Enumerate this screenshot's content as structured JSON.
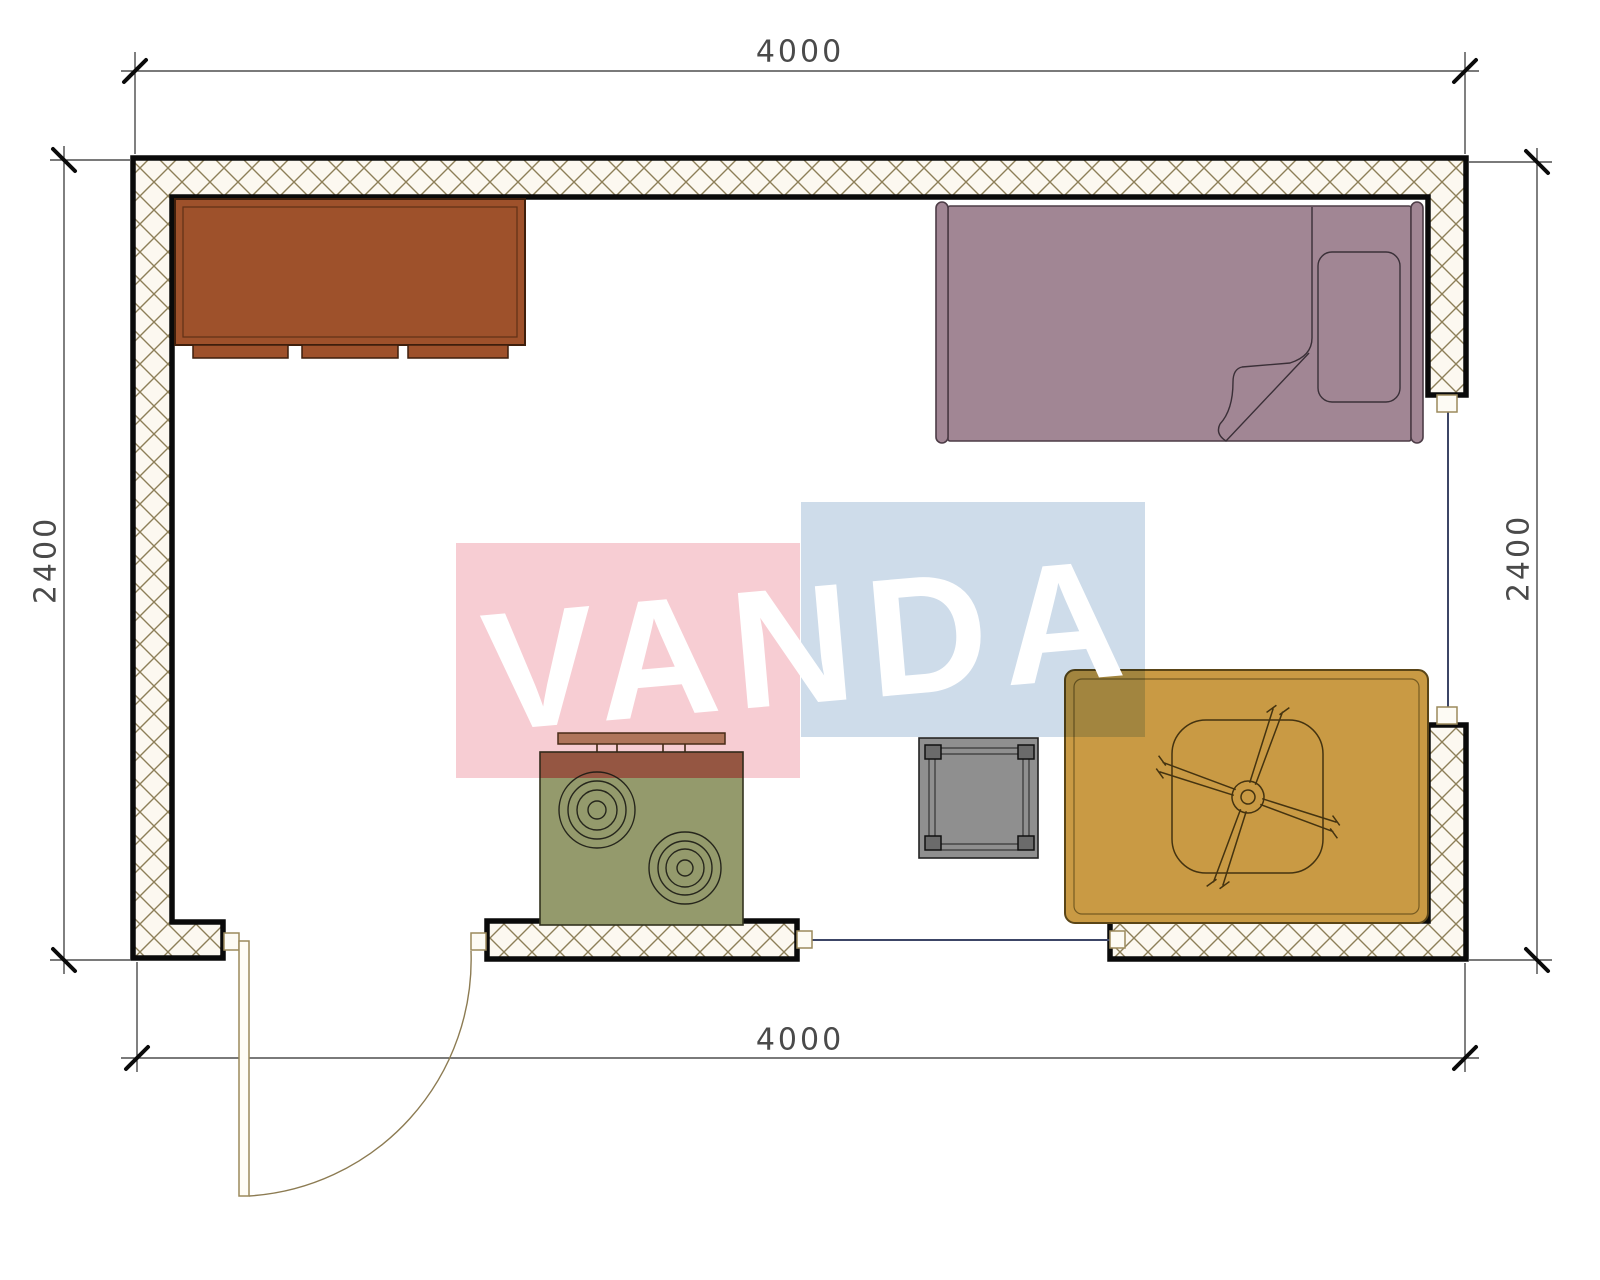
{
  "dimensions": {
    "top": "4000",
    "bottom": "4000",
    "left": "2400",
    "right": "2400"
  },
  "watermark": {
    "text": "VANDA",
    "pink_block": "#F7CDD3",
    "blue_block": "#CEDCEA",
    "text_color": "#FFFFFF"
  },
  "palette": {
    "wall_hatch_bg": "#FCF8F0",
    "hatch_line": "#8D7F58",
    "wall_border": "#0a0a0a",
    "dresser": "#9E512B",
    "bed": "#A18694",
    "stove_body": "#949A6C",
    "stove_top": "#9A6B4F",
    "stove_panel": "#B5916E",
    "table": "#8F8F8F",
    "table_leg": "#6B6B6B",
    "rug": "#C99A44",
    "door_line": "#9C8A5C",
    "window_line": "#3C4566",
    "dim_line": "#2b2b2b",
    "dim_text": "#4a4a4a"
  },
  "furniture": [
    {
      "name": "dresser"
    },
    {
      "name": "single-bed"
    },
    {
      "name": "stove"
    },
    {
      "name": "side-table"
    },
    {
      "name": "rug"
    },
    {
      "name": "ceiling-fan"
    },
    {
      "name": "door"
    },
    {
      "name": "window"
    }
  ]
}
